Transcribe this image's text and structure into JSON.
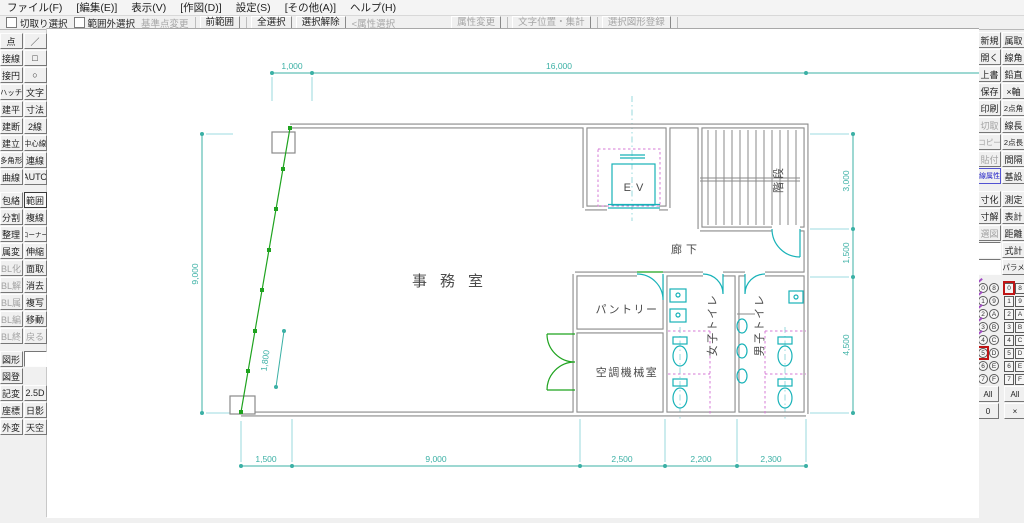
{
  "menu": {
    "items": [
      "ファイル(F)",
      "[編集(E)]",
      "表示(V)",
      "[作図(D)]",
      "設定(S)",
      "[その他(A)]",
      "ヘルプ(H)"
    ]
  },
  "toolbar": {
    "checkboxes": [
      {
        "label": "切取り選択",
        "checked": false
      },
      {
        "label": "範囲外選択",
        "checked": false
      }
    ],
    "buttons": [
      {
        "label": "基準点変更",
        "disabled": true,
        "flat": true
      },
      {
        "label": "前範囲",
        "disabled": false
      },
      {
        "label": "全選択",
        "disabled": false
      },
      {
        "label": "選択解除",
        "disabled": false
      },
      {
        "label": "<属性選択",
        "disabled": true,
        "flat": true
      },
      {
        "label": "属性変更",
        "disabled": true
      },
      {
        "label": "文字位置・集計",
        "disabled": true
      },
      {
        "label": "選択図形登録",
        "disabled": true
      }
    ]
  },
  "left_toolbar": {
    "rows": [
      {
        "g": 0,
        "c1": {
          "label": "点"
        },
        "c2": {
          "label": "／"
        }
      },
      {
        "g": 0,
        "c1": {
          "label": "接線"
        },
        "c2": {
          "label": "□"
        }
      },
      {
        "g": 0,
        "c1": {
          "label": "接円"
        },
        "c2": {
          "label": "○"
        }
      },
      {
        "g": 0,
        "c1": {
          "label": "ハッチ"
        },
        "c2": {
          "label": "文字"
        }
      },
      {
        "g": 0,
        "c1": {
          "label": "建平"
        },
        "c2": {
          "label": "寸法"
        }
      },
      {
        "g": 0,
        "c1": {
          "label": "建断"
        },
        "c2": {
          "label": "2線"
        }
      },
      {
        "g": 0,
        "c1": {
          "label": "建立"
        },
        "c2": {
          "label": "中心線"
        }
      },
      {
        "g": 0,
        "c1": {
          "label": "多角形"
        },
        "c2": {
          "label": "連線"
        }
      },
      {
        "g": 0,
        "c1": {
          "label": "曲線"
        },
        "c2": {
          "label": "AUTO"
        }
      },
      {
        "g": 1,
        "c1": {
          "label": "包絡"
        },
        "c2": {
          "label": "範囲",
          "selected": true
        }
      },
      {
        "g": 1,
        "c1": {
          "label": "分割"
        },
        "c2": {
          "label": "複線"
        }
      },
      {
        "g": 1,
        "c1": {
          "label": "整理"
        },
        "c2": {
          "label": "コーナー"
        }
      },
      {
        "g": 1,
        "c1": {
          "label": "属変"
        },
        "c2": {
          "label": "伸縮"
        }
      },
      {
        "g": 1,
        "c1": {
          "label": "BL化",
          "disabled": true
        },
        "c2": {
          "label": "面取"
        }
      },
      {
        "g": 1,
        "c1": {
          "label": "BL解",
          "disabled": true
        },
        "c2": {
          "label": "消去"
        }
      },
      {
        "g": 1,
        "c1": {
          "label": "BL属",
          "disabled": true
        },
        "c2": {
          "label": "複写"
        }
      },
      {
        "g": 1,
        "c1": {
          "label": "BL編",
          "disabled": true
        },
        "c2": {
          "label": "移動"
        }
      },
      {
        "g": 1,
        "c1": {
          "label": "BL終",
          "disabled": true
        },
        "c2": {
          "label": "戻る",
          "disabled": true
        }
      },
      {
        "g": 2,
        "c1": {
          "label": "図形"
        },
        "c2": {
          "label": "",
          "box": true
        }
      },
      {
        "g": 2,
        "c1": {
          "label": "図登"
        },
        "c2": {
          "label": "",
          "empty": true
        }
      },
      {
        "g": 2,
        "c1": {
          "label": "記変"
        },
        "c2": {
          "label": "2.5D"
        }
      },
      {
        "g": 2,
        "c1": {
          "label": "座標"
        },
        "c2": {
          "label": "日影"
        }
      },
      {
        "g": 2,
        "c1": {
          "label": "外変"
        },
        "c2": {
          "label": "天空"
        }
      }
    ]
  },
  "right_toolbar": {
    "rows": [
      {
        "g": 0,
        "c1": {
          "label": "新規"
        },
        "c2": {
          "label": "属取"
        }
      },
      {
        "g": 0,
        "c1": {
          "label": "開く"
        },
        "c2": {
          "label": "線角"
        }
      },
      {
        "g": 0,
        "c1": {
          "label": "上書"
        },
        "c2": {
          "label": "鉛直"
        }
      },
      {
        "g": 0,
        "c1": {
          "label": "保存"
        },
        "c2": {
          "label": "×軸"
        }
      },
      {
        "g": 0,
        "c1": {
          "label": "印刷"
        },
        "c2": {
          "label": "2点角"
        }
      },
      {
        "g": 0,
        "c1": {
          "label": "切取",
          "disabled": true
        },
        "c2": {
          "label": "線長"
        }
      },
      {
        "g": 0,
        "c1": {
          "label": "コピー",
          "disabled": true
        },
        "c2": {
          "label": "2点長"
        }
      },
      {
        "g": 0,
        "c1": {
          "label": "貼付",
          "disabled": true
        },
        "c2": {
          "label": "間隔"
        }
      },
      {
        "g": 0,
        "c1": {
          "label": "線属性",
          "accent": true
        },
        "c2": {
          "label": "基設"
        }
      },
      {
        "g": 1,
        "c1": {
          "label": "寸化"
        },
        "c2": {
          "label": "測定"
        }
      },
      {
        "g": 1,
        "c1": {
          "label": "寸解"
        },
        "c2": {
          "label": "表計"
        }
      },
      {
        "g": 1,
        "c1": {
          "label": "選図",
          "disabled": true
        },
        "c2": {
          "label": "距離"
        }
      },
      {
        "g": 1,
        "c1": {
          "label": "",
          "box": true
        },
        "c2": {
          "label": "式計"
        }
      },
      {
        "g": 1,
        "c1": {
          "label": "",
          "box": true
        },
        "c2": {
          "label": "パラメ"
        }
      }
    ]
  },
  "layer_panel": {
    "layers": {
      "col1": [
        "0",
        "1",
        "2",
        "3",
        "4",
        "5",
        "6",
        "7"
      ],
      "col2": [
        "8",
        "9",
        "A",
        "B",
        "C",
        "D",
        "E",
        "F"
      ],
      "selected": "5",
      "with_content": [
        "0",
        "1",
        "2",
        "3",
        "4"
      ]
    },
    "groups": {
      "col1": [
        "0",
        "1",
        "2",
        "3",
        "4",
        "5",
        "6",
        "7"
      ],
      "col2": [
        "8",
        "9",
        "A",
        "B",
        "C",
        "D",
        "E",
        "F"
      ],
      "selected": "0"
    },
    "footer_layers": [
      "All",
      "0"
    ],
    "footer_groups": [
      "All",
      "×"
    ]
  },
  "canvas": {
    "rooms": {
      "office": "事務室",
      "ev": "EV",
      "stairs": "階段",
      "corridor": "廊下",
      "pantry": "パントリー",
      "machine": "空調機械室",
      "womens": "女子トイレ",
      "mens": "男子トイレ"
    },
    "dims": {
      "top": [
        "1,000",
        "16,000"
      ],
      "bottom": [
        "1,500",
        "9,000",
        "2,500",
        "2,200",
        "2,300"
      ],
      "left": [
        "9,000"
      ],
      "right": [
        "3,000",
        "1,500",
        "4,500"
      ],
      "wall": "1,800"
    },
    "colors": {
      "wall": "#8a8a8a",
      "fixture": "#17b2b8",
      "dimension": "#3bb0a5",
      "selection_green": "#1fa31f",
      "stall_magenta": "#d678d6",
      "centerline": "#7fd0d6",
      "text": "#4a4a4a"
    }
  }
}
